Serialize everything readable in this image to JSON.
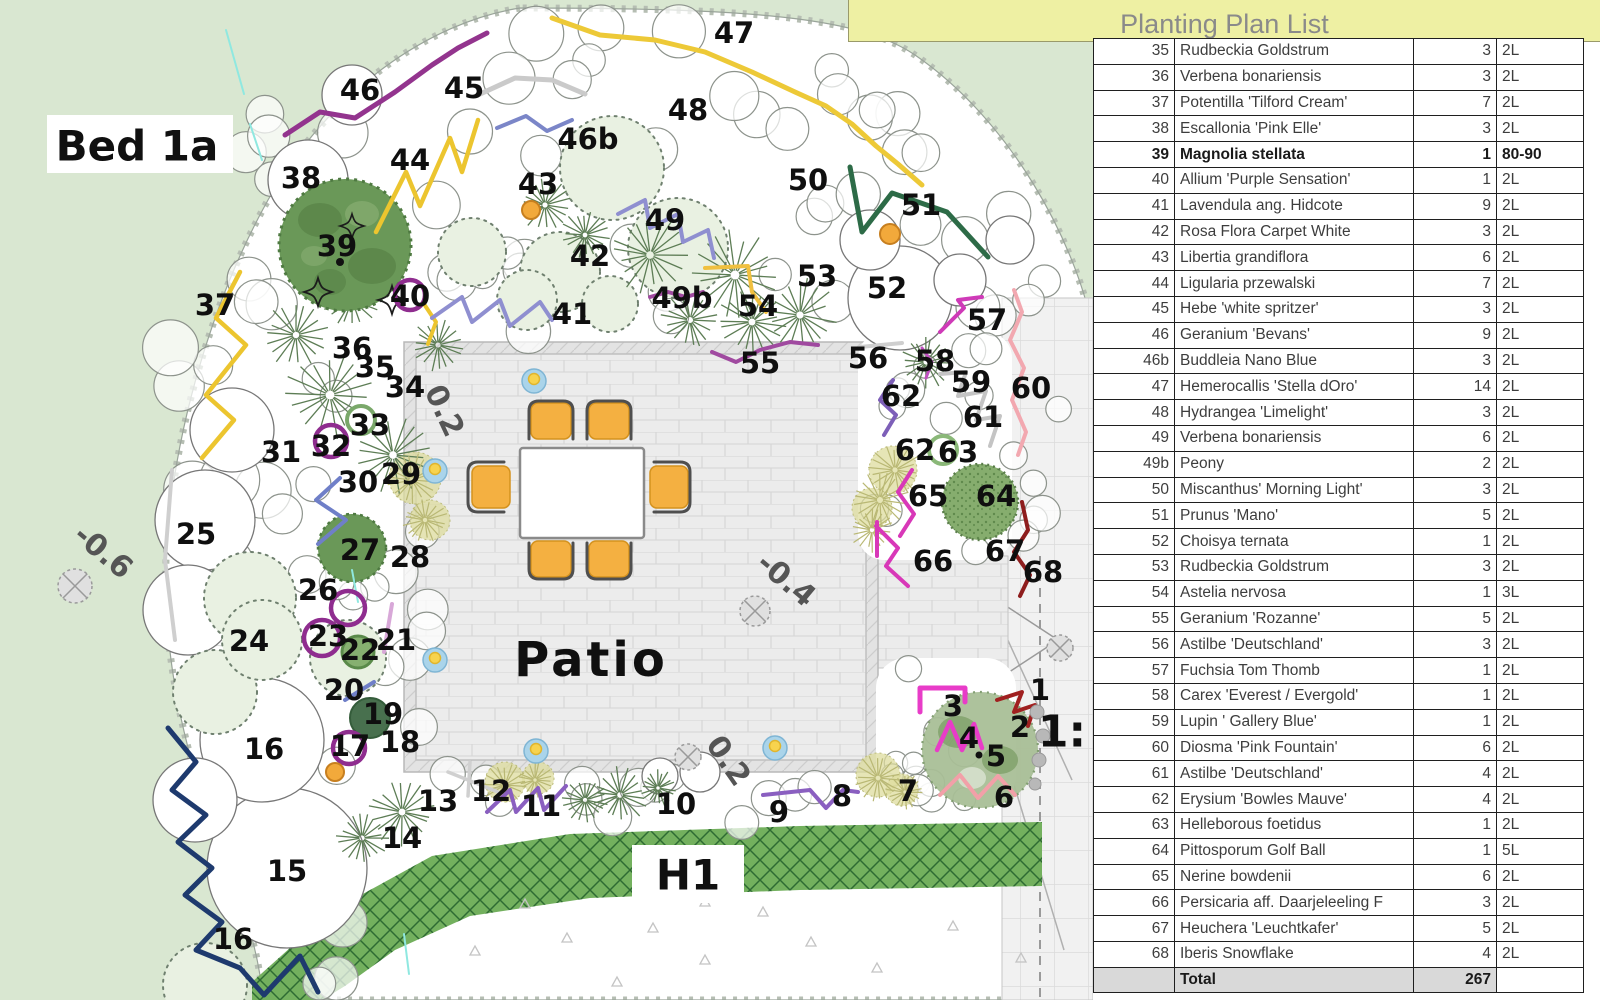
{
  "title": {
    "text": "Planting Plan List"
  },
  "plan": {
    "bed_label": "Bed 1a",
    "patio_label": "Patio",
    "hedge_label": "H1",
    "scale_label": "1:",
    "level_labels": [
      {
        "text": "-0.6",
        "x": 103,
        "y": 552,
        "rot": 40
      },
      {
        "text": "-0.4",
        "x": 786,
        "y": 580,
        "rot": 40
      },
      {
        "text": "0.2",
        "x": 444,
        "y": 411,
        "rot": 65
      },
      {
        "text": "0.2",
        "x": 728,
        "y": 761,
        "rot": 55
      }
    ],
    "number_labels": [
      {
        "t": "47",
        "x": 734,
        "y": 33
      },
      {
        "t": "46",
        "x": 360,
        "y": 90
      },
      {
        "t": "45",
        "x": 464,
        "y": 88
      },
      {
        "t": "44",
        "x": 410,
        "y": 160
      },
      {
        "t": "46b",
        "x": 588,
        "y": 139
      },
      {
        "t": "48",
        "x": 688,
        "y": 110
      },
      {
        "t": "38",
        "x": 301,
        "y": 178
      },
      {
        "t": "43",
        "x": 538,
        "y": 184
      },
      {
        "t": "39",
        "x": 337,
        "y": 246
      },
      {
        "t": "37",
        "x": 215,
        "y": 305
      },
      {
        "t": "40",
        "x": 410,
        "y": 296
      },
      {
        "t": "42",
        "x": 590,
        "y": 256
      },
      {
        "t": "49",
        "x": 665,
        "y": 220
      },
      {
        "t": "41",
        "x": 572,
        "y": 314
      },
      {
        "t": "50",
        "x": 808,
        "y": 180
      },
      {
        "t": "51",
        "x": 921,
        "y": 205
      },
      {
        "t": "52",
        "x": 887,
        "y": 288
      },
      {
        "t": "53",
        "x": 817,
        "y": 276
      },
      {
        "t": "54",
        "x": 758,
        "y": 306
      },
      {
        "t": "49b",
        "x": 682,
        "y": 298
      },
      {
        "t": "55",
        "x": 760,
        "y": 363
      },
      {
        "t": "56",
        "x": 868,
        "y": 358
      },
      {
        "t": "57",
        "x": 987,
        "y": 320
      },
      {
        "t": "58",
        "x": 935,
        "y": 361
      },
      {
        "t": "59",
        "x": 971,
        "y": 382
      },
      {
        "t": "60",
        "x": 1031,
        "y": 388
      },
      {
        "t": "61",
        "x": 983,
        "y": 417
      },
      {
        "t": "62",
        "x": 901,
        "y": 396
      },
      {
        "t": "62",
        "x": 915,
        "y": 450
      },
      {
        "t": "63",
        "x": 958,
        "y": 452
      },
      {
        "t": "64",
        "x": 996,
        "y": 496
      },
      {
        "t": "65",
        "x": 928,
        "y": 496
      },
      {
        "t": "66",
        "x": 933,
        "y": 561
      },
      {
        "t": "67",
        "x": 1005,
        "y": 551
      },
      {
        "t": "68",
        "x": 1043,
        "y": 572
      },
      {
        "t": "34",
        "x": 405,
        "y": 387
      },
      {
        "t": "35",
        "x": 375,
        "y": 367
      },
      {
        "t": "36",
        "x": 352,
        "y": 348
      },
      {
        "t": "31",
        "x": 281,
        "y": 452
      },
      {
        "t": "32",
        "x": 331,
        "y": 446
      },
      {
        "t": "33",
        "x": 370,
        "y": 425
      },
      {
        "t": "30",
        "x": 358,
        "y": 482
      },
      {
        "t": "29",
        "x": 401,
        "y": 474
      },
      {
        "t": "25",
        "x": 196,
        "y": 534
      },
      {
        "t": "26",
        "x": 318,
        "y": 590
      },
      {
        "t": "27",
        "x": 360,
        "y": 550
      },
      {
        "t": "28",
        "x": 410,
        "y": 557
      },
      {
        "t": "24",
        "x": 249,
        "y": 641
      },
      {
        "t": "23",
        "x": 328,
        "y": 636
      },
      {
        "t": "22",
        "x": 360,
        "y": 650
      },
      {
        "t": "21",
        "x": 396,
        "y": 640
      },
      {
        "t": "20",
        "x": 344,
        "y": 690
      },
      {
        "t": "19",
        "x": 383,
        "y": 714
      },
      {
        "t": "18",
        "x": 400,
        "y": 742
      },
      {
        "t": "17",
        "x": 350,
        "y": 746
      },
      {
        "t": "16",
        "x": 264,
        "y": 749
      },
      {
        "t": "15",
        "x": 287,
        "y": 871
      },
      {
        "t": "16",
        "x": 233,
        "y": 939
      },
      {
        "t": "14",
        "x": 402,
        "y": 838
      },
      {
        "t": "13",
        "x": 438,
        "y": 801
      },
      {
        "t": "12",
        "x": 491,
        "y": 791
      },
      {
        "t": "11",
        "x": 541,
        "y": 806
      },
      {
        "t": "10",
        "x": 676,
        "y": 804
      },
      {
        "t": "9",
        "x": 779,
        "y": 812
      },
      {
        "t": "8",
        "x": 842,
        "y": 796
      },
      {
        "t": "7",
        "x": 908,
        "y": 791
      },
      {
        "t": "6",
        "x": 1004,
        "y": 797
      },
      {
        "t": "5",
        "x": 996,
        "y": 756
      },
      {
        "t": "4",
        "x": 969,
        "y": 738
      },
      {
        "t": "3",
        "x": 953,
        "y": 706
      },
      {
        "t": "2",
        "x": 1020,
        "y": 727
      },
      {
        "t": "1",
        "x": 1040,
        "y": 690
      }
    ]
  },
  "table": {
    "rows": [
      {
        "no": "35",
        "name": "Rudbeckia Goldstrum",
        "qty": "3",
        "size": "2L",
        "bold": false
      },
      {
        "no": "36",
        "name": "Verbena bonariensis",
        "qty": "3",
        "size": "2L",
        "bold": false
      },
      {
        "no": "37",
        "name": "Potentilla 'Tilford Cream'",
        "qty": "7",
        "size": "2L",
        "bold": false
      },
      {
        "no": "38",
        "name": "Escallonia 'Pink Elle'",
        "qty": "3",
        "size": "2L",
        "bold": false
      },
      {
        "no": "39",
        "name": "Magnolia stellata",
        "qty": "1",
        "size": "80-90",
        "bold": true
      },
      {
        "no": "40",
        "name": "Allium 'Purple Sensation'",
        "qty": "1",
        "size": "2L",
        "bold": false
      },
      {
        "no": "41",
        "name": "Lavendula ang. Hidcote",
        "qty": "9",
        "size": "2L",
        "bold": false
      },
      {
        "no": "42",
        "name": "Rosa Flora Carpet White",
        "qty": "3",
        "size": "2L",
        "bold": false
      },
      {
        "no": "43",
        "name": "Libertia grandiflora",
        "qty": "6",
        "size": "2L",
        "bold": false
      },
      {
        "no": "44",
        "name": "Ligularia przewalski",
        "qty": "7",
        "size": "2L",
        "bold": false
      },
      {
        "no": "45",
        "name": "Hebe 'white spritzer'",
        "qty": "3",
        "size": "2L",
        "bold": false
      },
      {
        "no": "46",
        "name": "Geranium 'Bevans'",
        "qty": "9",
        "size": "2L",
        "bold": false
      },
      {
        "no": "46b",
        "name": "Buddleia Nano Blue",
        "qty": "3",
        "size": "2L",
        "bold": false
      },
      {
        "no": "47",
        "name": "Hemerocallis 'Stella dOro'",
        "qty": "14",
        "size": "2L",
        "bold": false
      },
      {
        "no": "48",
        "name": "Hydrangea 'Limelight'",
        "qty": "3",
        "size": "2L",
        "bold": false
      },
      {
        "no": "49",
        "name": "Verbena bonariensis",
        "qty": "6",
        "size": "2L",
        "bold": false
      },
      {
        "no": "49b",
        "name": "Peony",
        "qty": "2",
        "size": "2L",
        "bold": false
      },
      {
        "no": "50",
        "name": "Miscanthus' Morning Light'",
        "qty": "3",
        "size": "2L",
        "bold": false
      },
      {
        "no": "51",
        "name": "Prunus 'Mano'",
        "qty": "5",
        "size": "2L",
        "bold": false
      },
      {
        "no": "52",
        "name": "Choisya ternata",
        "qty": "1",
        "size": "2L",
        "bold": false
      },
      {
        "no": "53",
        "name": "Rudbeckia Goldstrum",
        "qty": "3",
        "size": "2L",
        "bold": false
      },
      {
        "no": "54",
        "name": "Astelia nervosa",
        "qty": "1",
        "size": "3L",
        "bold": false
      },
      {
        "no": "55",
        "name": "Geranium 'Rozanne'",
        "qty": "5",
        "size": "2L",
        "bold": false
      },
      {
        "no": "56",
        "name": "Astilbe 'Deutschland'",
        "qty": "3",
        "size": "2L",
        "bold": false
      },
      {
        "no": "57",
        "name": "Fuchsia Tom Thomb",
        "qty": "1",
        "size": "2L",
        "bold": false
      },
      {
        "no": "58",
        "name": "Carex 'Everest / Evergold'",
        "qty": "1",
        "size": "2L",
        "bold": false
      },
      {
        "no": "59",
        "name": "Lupin ' Gallery Blue'",
        "qty": "1",
        "size": "2L",
        "bold": false
      },
      {
        "no": "60",
        "name": "Diosma 'Pink Fountain'",
        "qty": "6",
        "size": "2L",
        "bold": false
      },
      {
        "no": "61",
        "name": "Astilbe 'Deutschland'",
        "qty": "4",
        "size": "2L",
        "bold": false
      },
      {
        "no": "62",
        "name": "Erysium 'Bowles Mauve'",
        "qty": "4",
        "size": "2L",
        "bold": false
      },
      {
        "no": "63",
        "name": "Helleborous foetidus",
        "qty": "1",
        "size": "2L",
        "bold": false
      },
      {
        "no": "64",
        "name": "Pittosporum Golf Ball",
        "qty": "1",
        "size": "5L",
        "bold": false
      },
      {
        "no": "65",
        "name": "Nerine bowdenii",
        "qty": "6",
        "size": "2L",
        "bold": false
      },
      {
        "no": "66",
        "name": "Persicaria aff. Daarjeleeling F",
        "qty": "3",
        "size": "2L",
        "bold": false
      },
      {
        "no": "67",
        "name": "Heuchera 'Leuchtkafer'",
        "qty": "5",
        "size": "2L",
        "bold": false
      },
      {
        "no": "68",
        "name": "Iberis Snowflake",
        "qty": "4",
        "size": "2L",
        "bold": false
      }
    ],
    "total_row": {
      "label": "Total",
      "qty": "267"
    }
  },
  "colors": {
    "lawn": "#d9e7d1",
    "bed": "#ffffff",
    "hedge": "#73b05e",
    "hedge_hatch": "#2e6b33",
    "patio": "#ececec",
    "header_yellow": "#eef0a3",
    "total_gray": "#d9d9d9",
    "chair_orange": "#f4b041",
    "tree_dark_green": "#6a9858",
    "ring_purple": "#8f2d8f"
  }
}
